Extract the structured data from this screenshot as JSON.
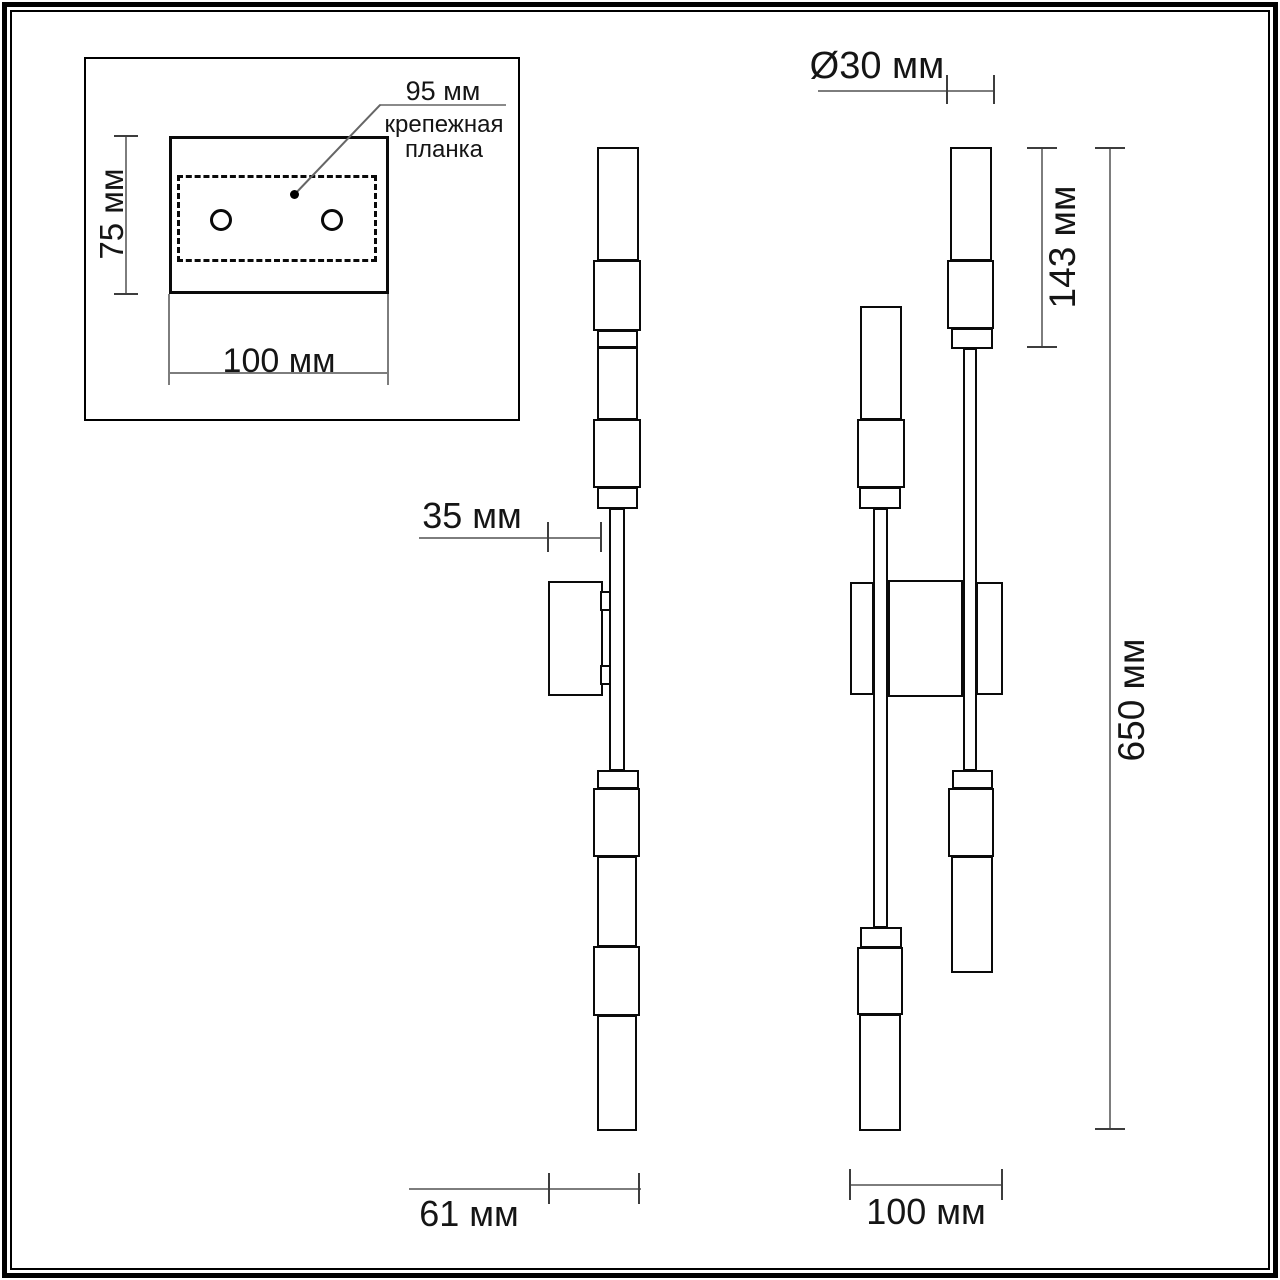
{
  "document": {
    "kind": "technical-drawing",
    "subject": "wall sconce dimensional diagram"
  },
  "colors": {
    "background": "#ffffff",
    "outline": "#0a0a0a",
    "dimension_line": "#7d7d7d",
    "text": "#151515"
  },
  "inset": {
    "hole_spacing_label": "95 мм",
    "plate_label": "крепежная планка",
    "height_label": "75 мм",
    "width_label": "100 мм"
  },
  "side_view": {
    "wall_offset_label": "35 мм",
    "depth_label": "61 мм"
  },
  "front_view": {
    "diameter_label": "Ø30 мм",
    "tube_length_label": "143 мм",
    "total_height_label": "650 мм",
    "width_label": "100 мм"
  }
}
